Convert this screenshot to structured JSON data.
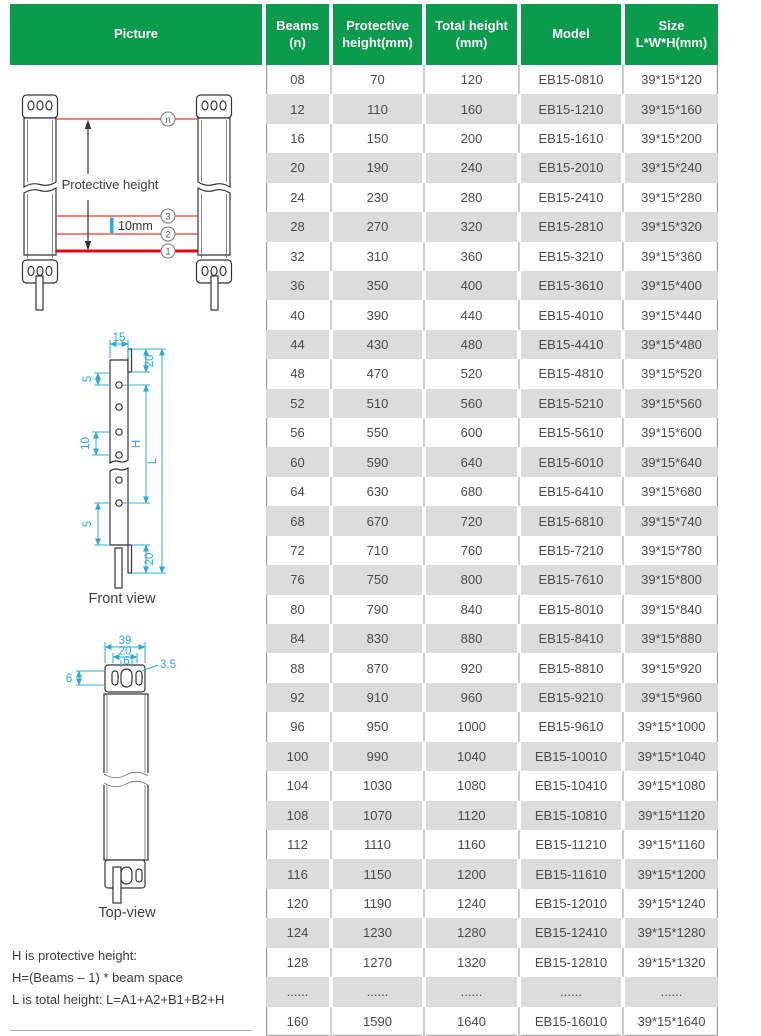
{
  "table": {
    "columns": [
      {
        "label": "Picture"
      },
      {
        "label": "Beams\n(n)"
      },
      {
        "label": "Protective\nheight(mm)"
      },
      {
        "label": "Total height\n(mm)"
      },
      {
        "label": "Model"
      },
      {
        "label": "Size\nL*W*H(mm)"
      }
    ],
    "rows": [
      [
        "08",
        "70",
        "120",
        "EB15-0810",
        "39*15*120"
      ],
      [
        "12",
        "110",
        "160",
        "EB15-1210",
        "39*15*160"
      ],
      [
        "16",
        "150",
        "200",
        "EB15-1610",
        "39*15*200"
      ],
      [
        "20",
        "190",
        "240",
        "EB15-2010",
        "39*15*240"
      ],
      [
        "24",
        "230",
        "280",
        "EB15-2410",
        "39*15*280"
      ],
      [
        "28",
        "270",
        "320",
        "EB15-2810",
        "39*15*320"
      ],
      [
        "32",
        "310",
        "360",
        "EB15-3210",
        "39*15*360"
      ],
      [
        "36",
        "350",
        "400",
        "EB15-3610",
        "39*15*400"
      ],
      [
        "40",
        "390",
        "440",
        "EB15-4010",
        "39*15*440"
      ],
      [
        "44",
        "430",
        "480",
        "EB15-4410",
        "39*15*480"
      ],
      [
        "48",
        "470",
        "520",
        "EB15-4810",
        "39*15*520"
      ],
      [
        "52",
        "510",
        "560",
        "EB15-5210",
        "39*15*560"
      ],
      [
        "56",
        "550",
        "600",
        "EB15-5610",
        "39*15*600"
      ],
      [
        "60",
        "590",
        "640",
        "EB15-6010",
        "39*15*640"
      ],
      [
        "64",
        "630",
        "680",
        "EB15-6410",
        "39*15*680"
      ],
      [
        "68",
        "670",
        "720",
        "EB15-6810",
        "39*15*740"
      ],
      [
        "72",
        "710",
        "760",
        "EB15-7210",
        "39*15*780"
      ],
      [
        "76",
        "750",
        "800",
        "EB15-7610",
        "39*15*800"
      ],
      [
        "80",
        "790",
        "840",
        "EB15-8010",
        "39*15*840"
      ],
      [
        "84",
        "830",
        "880",
        "EB15-8410",
        "39*15*880"
      ],
      [
        "88",
        "870",
        "920",
        "EB15-8810",
        "39*15*920"
      ],
      [
        "92",
        "910",
        "960",
        "EB15-9210",
        "39*15*960"
      ],
      [
        "96",
        "950",
        "1000",
        "EB15-9610",
        "39*15*1000"
      ],
      [
        "100",
        "990",
        "1040",
        "EB15-10010",
        "39*15*1040"
      ],
      [
        "104",
        "1030",
        "1080",
        "EB15-10410",
        "39*15*1080"
      ],
      [
        "108",
        "1070",
        "1120",
        "EB15-10810",
        "39*15*1120"
      ],
      [
        "112",
        "1110",
        "1160",
        "EB15-11210",
        "39*15*1160"
      ],
      [
        "116",
        "1150",
        "1200",
        "EB15-11610",
        "39*15*1200"
      ],
      [
        "120",
        "1190",
        "1240",
        "EB15-12010",
        "39*15*1240"
      ],
      [
        "124",
        "1230",
        "1280",
        "EB15-12410",
        "39*15*1280"
      ],
      [
        "128",
        "1270",
        "1320",
        "EB15-12810",
        "39*15*1320"
      ],
      [
        "......",
        "......",
        "......",
        "......",
        "......"
      ],
      [
        "160",
        "1590",
        "1640",
        "EB15-16010",
        "39*15*1640"
      ]
    ]
  },
  "diagrams": {
    "beams_view": {
      "beam_labels": {
        "top": "n",
        "b3": "3",
        "b2": "2",
        "b1": "1"
      },
      "protective_height": "Protective height",
      "beam_space": "10mm"
    },
    "front_view": {
      "title": "Front view",
      "dim_top_width": "15",
      "dim_top_end": "20",
      "dim_first_beam": "5",
      "dim_beam_space": "10",
      "dim_h": "H",
      "dim_l": "L",
      "dim_last_beam": "5",
      "dim_bottom_end": "20"
    },
    "top_view": {
      "title": "Top-view",
      "dim_width": "39",
      "dim_inner": "20",
      "dim_hole_space": "6",
      "dim_hole_dia": "3.5",
      "dim_side": "6"
    },
    "notes": {
      "line1": "H is protective height:",
      "line2": "H=(Beams – 1) * beam space",
      "line3": "L is total height: L=A1+A2+B1+B2+H"
    }
  },
  "colors": {
    "header_green": "#0a9b4c",
    "row_alt": "#dcdcdc",
    "beam_red": "#e23a2e",
    "beam_red_bold": "#e60012",
    "dim_blue": "#29abe2"
  }
}
